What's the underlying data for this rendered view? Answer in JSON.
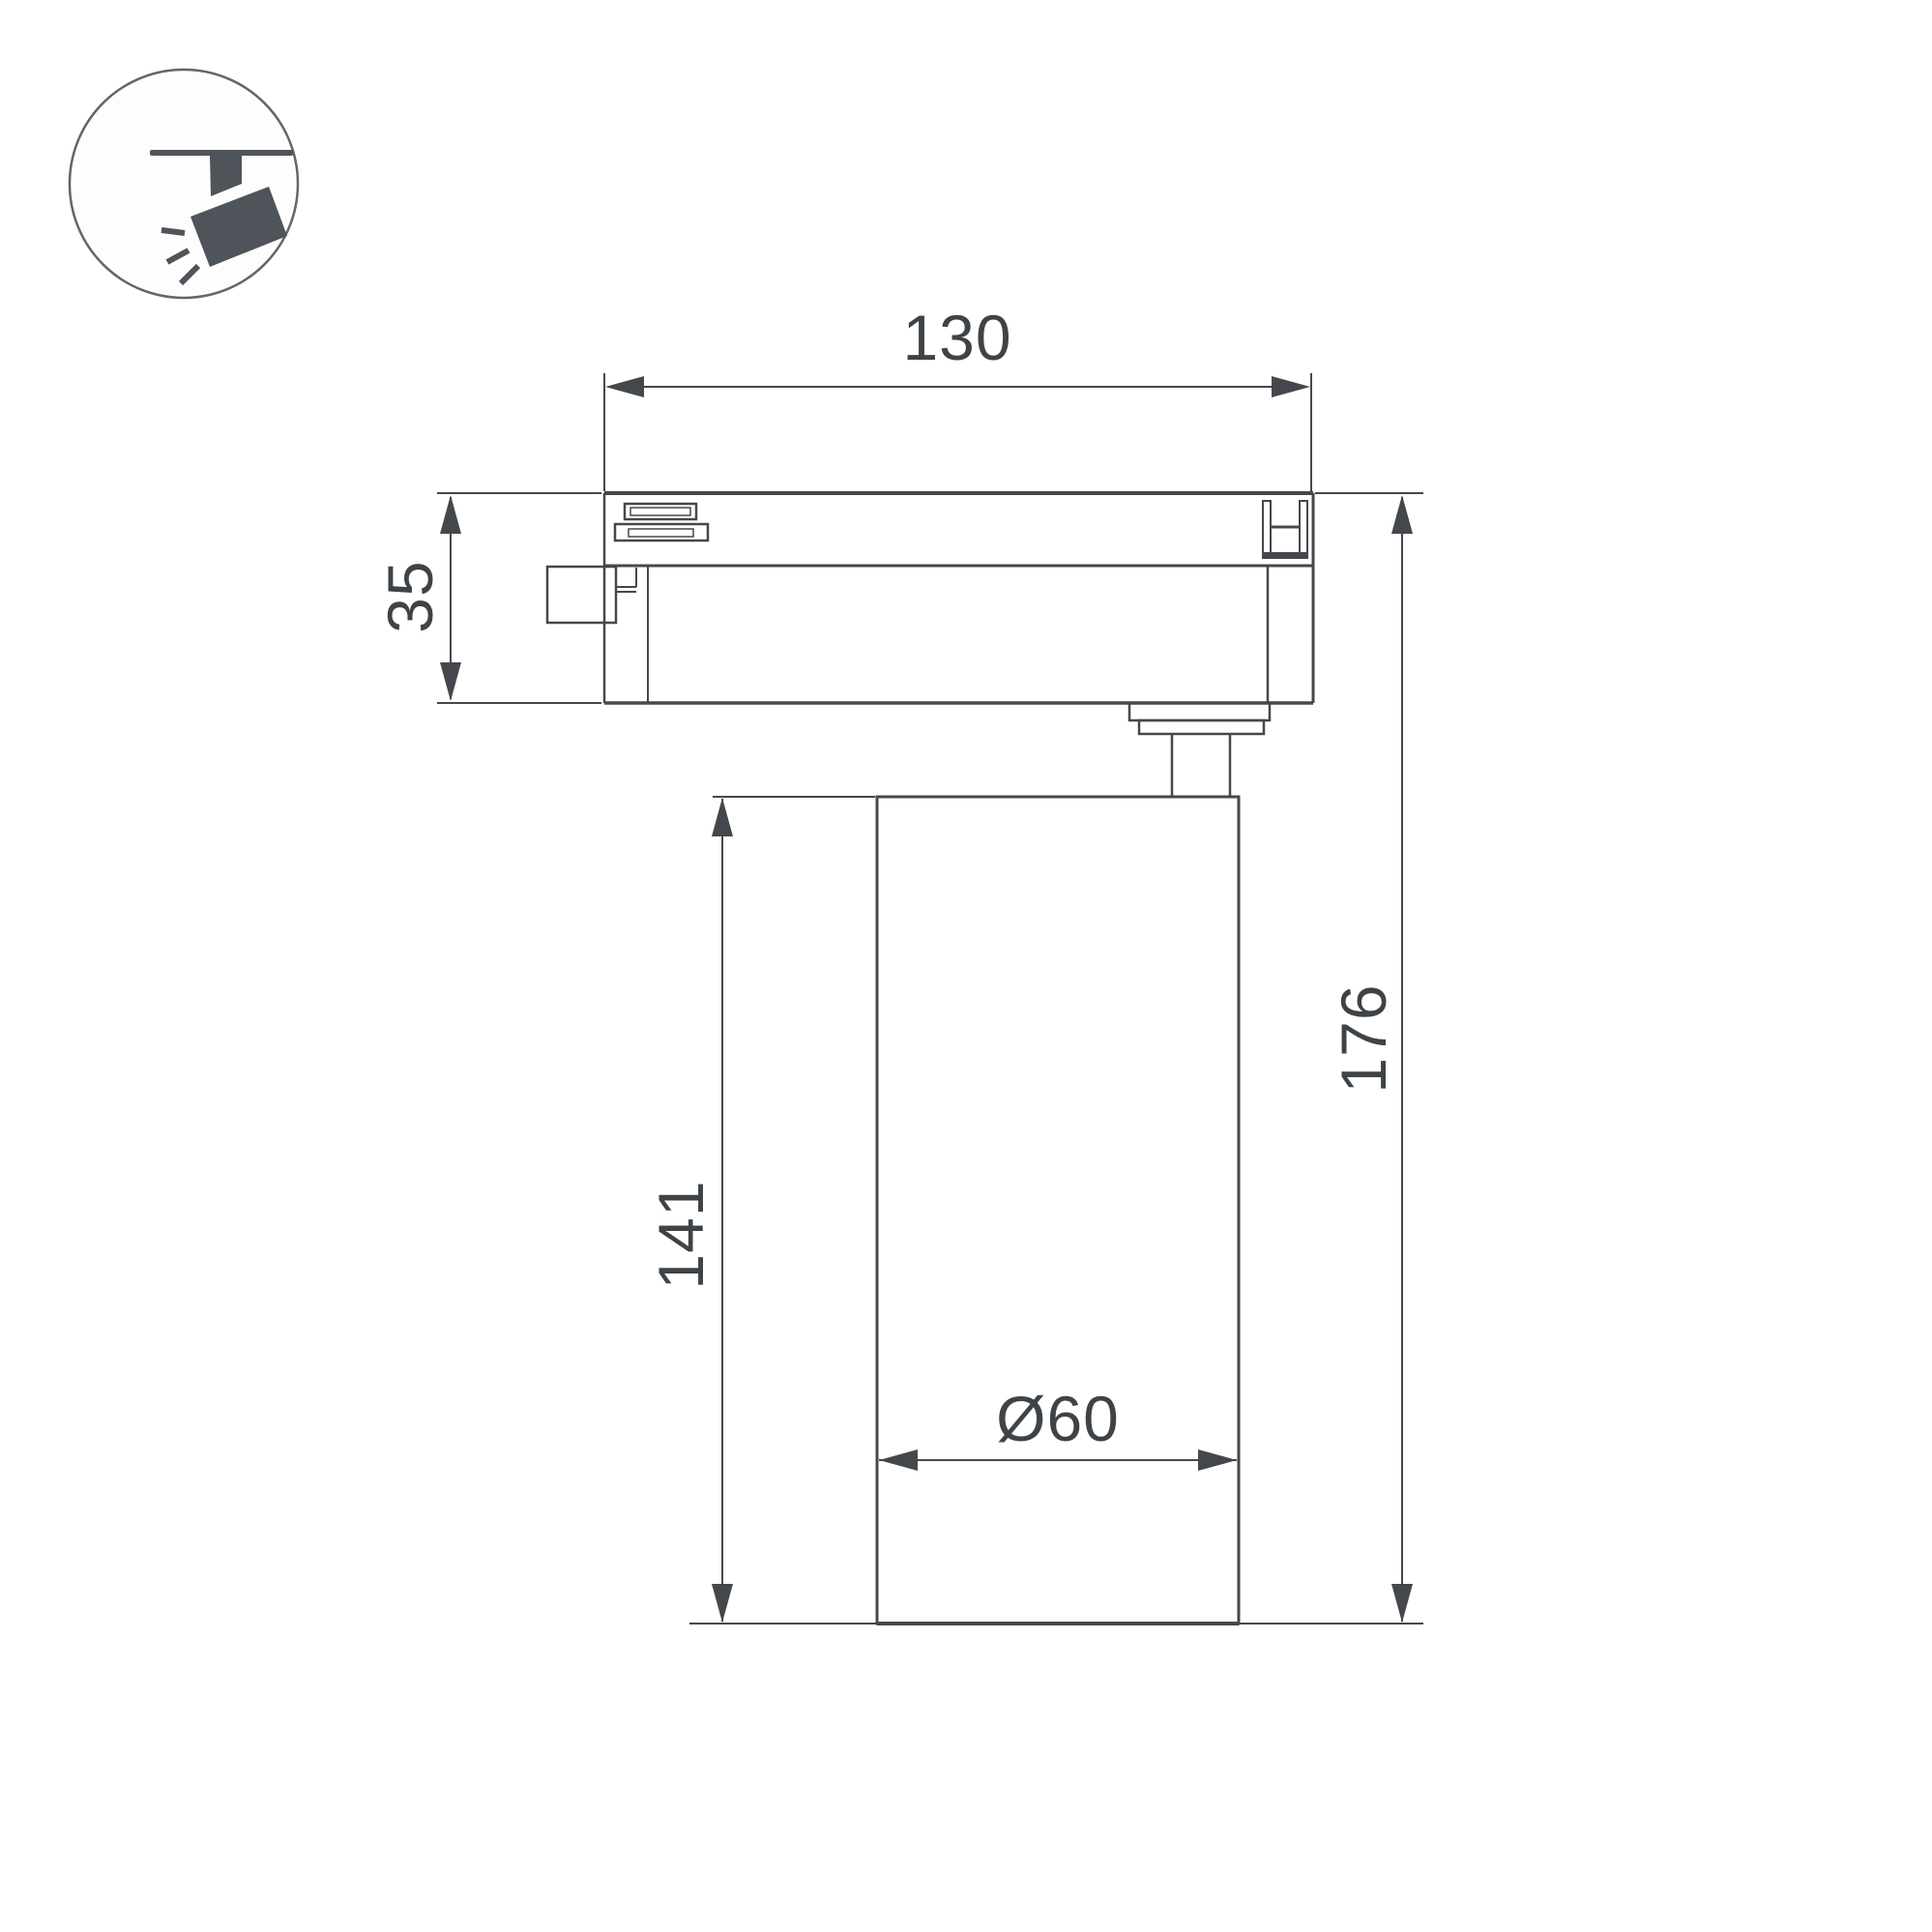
{
  "colors": {
    "background": "#ffffff",
    "line": "#44484c",
    "text": "#3e4347",
    "icon": "#4e545a",
    "icon_circle_stroke": "#61666b"
  },
  "icon": {
    "semantic": "ceiling-track-spotlight-icon"
  },
  "dimensions": {
    "track_adapter_width": "130",
    "track_adapter_height": "35",
    "body_height": "141",
    "total_height": "176",
    "body_diameter": "Ø60"
  }
}
